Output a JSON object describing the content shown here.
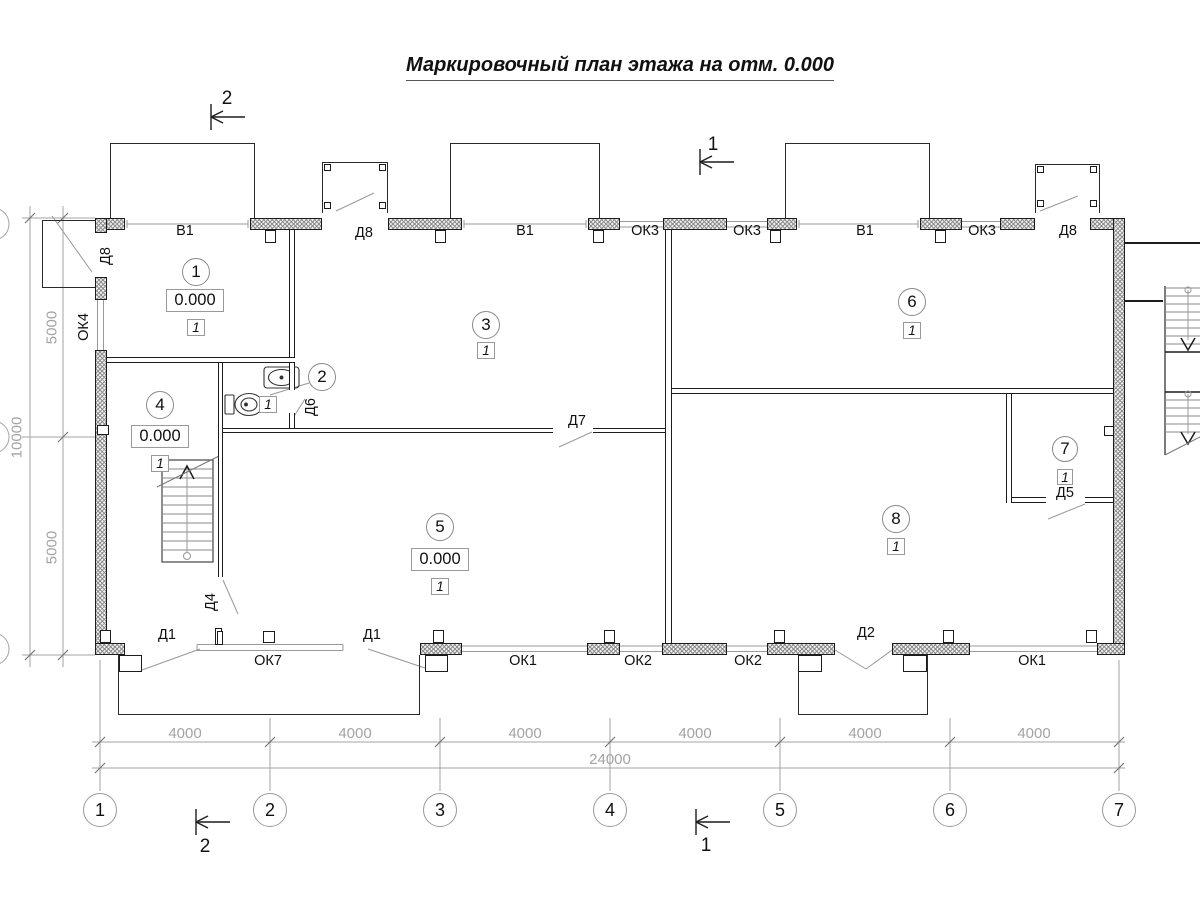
{
  "title": "Маркировочный план этажа на отм. 0.000",
  "openings": {
    "top": [
      "Д8",
      "В1",
      "Д8",
      "В1",
      "ОК3",
      "ОК3",
      "В1",
      "ОК3",
      "Д8"
    ],
    "left": [
      "ОК4"
    ],
    "bottom": [
      "Д1",
      "ОК7",
      "Д1",
      "ОК1",
      "ОК2",
      "ОК2",
      "Д2",
      "ОК1"
    ],
    "interior": [
      "Д6",
      "Д7",
      "Д4",
      "Д5"
    ]
  },
  "rooms": [
    {
      "number": "1",
      "elevation": "0.000",
      "finish": "1"
    },
    {
      "number": "2",
      "finish": "1"
    },
    {
      "number": "3",
      "finish": "1"
    },
    {
      "number": "4",
      "elevation": "0.000",
      "finish": "1"
    },
    {
      "number": "5",
      "elevation": "0.000",
      "finish": "1"
    },
    {
      "number": "6",
      "finish": "1"
    },
    {
      "number": "7",
      "finish": "1"
    },
    {
      "number": "8",
      "finish": "1"
    }
  ],
  "axes": [
    "1",
    "2",
    "3",
    "4",
    "5",
    "6",
    "7"
  ],
  "dimensions": {
    "bays": [
      "4000",
      "4000",
      "4000",
      "4000",
      "4000",
      "4000"
    ],
    "total": "24000",
    "left_upper": "5000",
    "left_total": "10000",
    "left_lower": "5000"
  },
  "sections": {
    "top_left_mark": "2",
    "top_right_mark": "1",
    "bottom_left_mark": "2",
    "bottom_right_mark": "1"
  },
  "colors": {
    "line": "#1c1c1c",
    "dim": "#a3a3a3",
    "hatch": "#8f8f8f"
  }
}
